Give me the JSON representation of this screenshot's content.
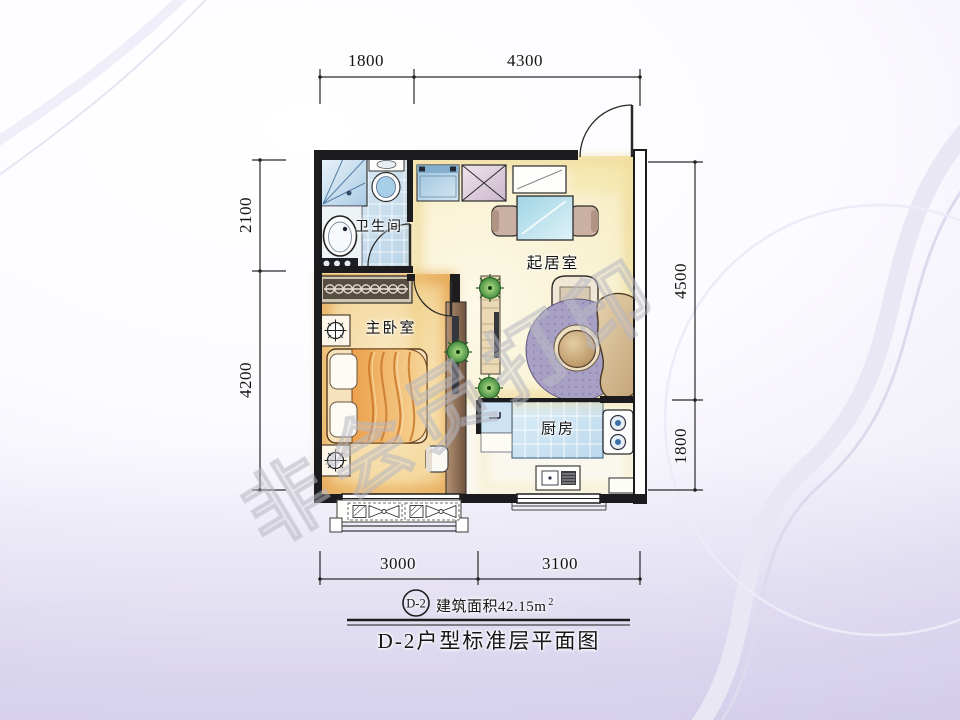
{
  "slide": {
    "watermark_text": "非会员打印"
  },
  "plan": {
    "rooms": {
      "bathroom": "卫生间",
      "bedroom": "主卧室",
      "living": "起居室",
      "kitchen": "厨房"
    },
    "dimensions": {
      "top_left": "1800",
      "top_right": "4300",
      "left_top": "2100",
      "left_bottom": "4200",
      "right_top": "4500",
      "right_bottom": "1800",
      "bottom_left": "3000",
      "bottom_right": "3100"
    }
  },
  "footer": {
    "unit_code": "D-2",
    "area_label": "建筑面积42.15m",
    "area_superscript": "2",
    "title": "D-2户型标准层平面图"
  }
}
